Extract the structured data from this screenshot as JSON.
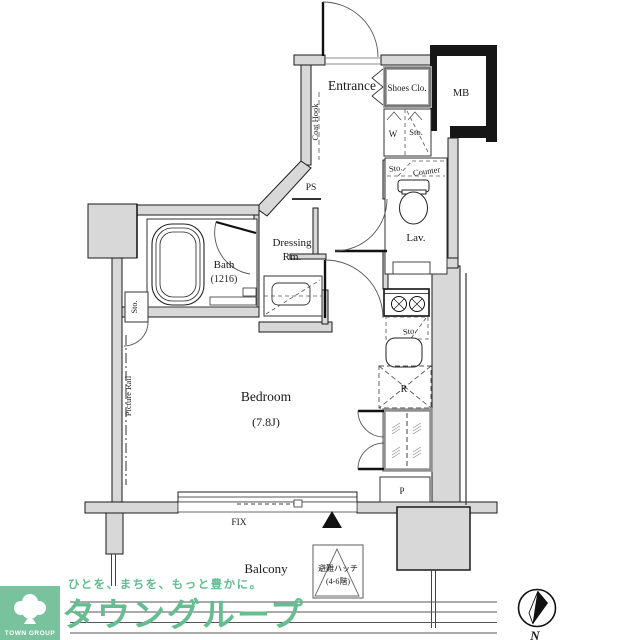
{
  "colors": {
    "wall_gray": "#d8d8d8",
    "wall_dark": "#161616",
    "line": "#1a1a1a",
    "brand_green": "#66bd92",
    "logo_green": "#78c39d"
  },
  "plan": {
    "entrance": {
      "label": "Entrance",
      "coat_hook": "Coat Hook",
      "shoes_closet": "Shoes Clo.",
      "meter_box": "MB",
      "washer": "W",
      "storage": "Sto."
    },
    "lavatory": {
      "label": "Lav.",
      "storage": "Sto.",
      "counter": "Counter"
    },
    "pipe_space": "PS",
    "dressing_room": {
      "line1": "Dressing",
      "line2": "Rm."
    },
    "bath": {
      "label": "Bath",
      "size": "(1216)",
      "storage": "Sto."
    },
    "bedroom": {
      "label": "Bedroom",
      "size": "(7.8J)",
      "picture_rail": "Picture Rail"
    },
    "kitchen": {
      "storage": "Sto.",
      "refrigerator": "R",
      "pipe": "P"
    },
    "window": {
      "label": "FIX"
    },
    "balcony": {
      "label": "Balcony",
      "hatch_line1": "避難ハッチ",
      "hatch_line2": "(4-6階)"
    },
    "compass": {
      "label": "N"
    }
  },
  "footer": {
    "logo_text": "TOWN GROUP",
    "tagline": "ひとを、まちを、もっと豊かに。",
    "brand": "タウングループ"
  }
}
